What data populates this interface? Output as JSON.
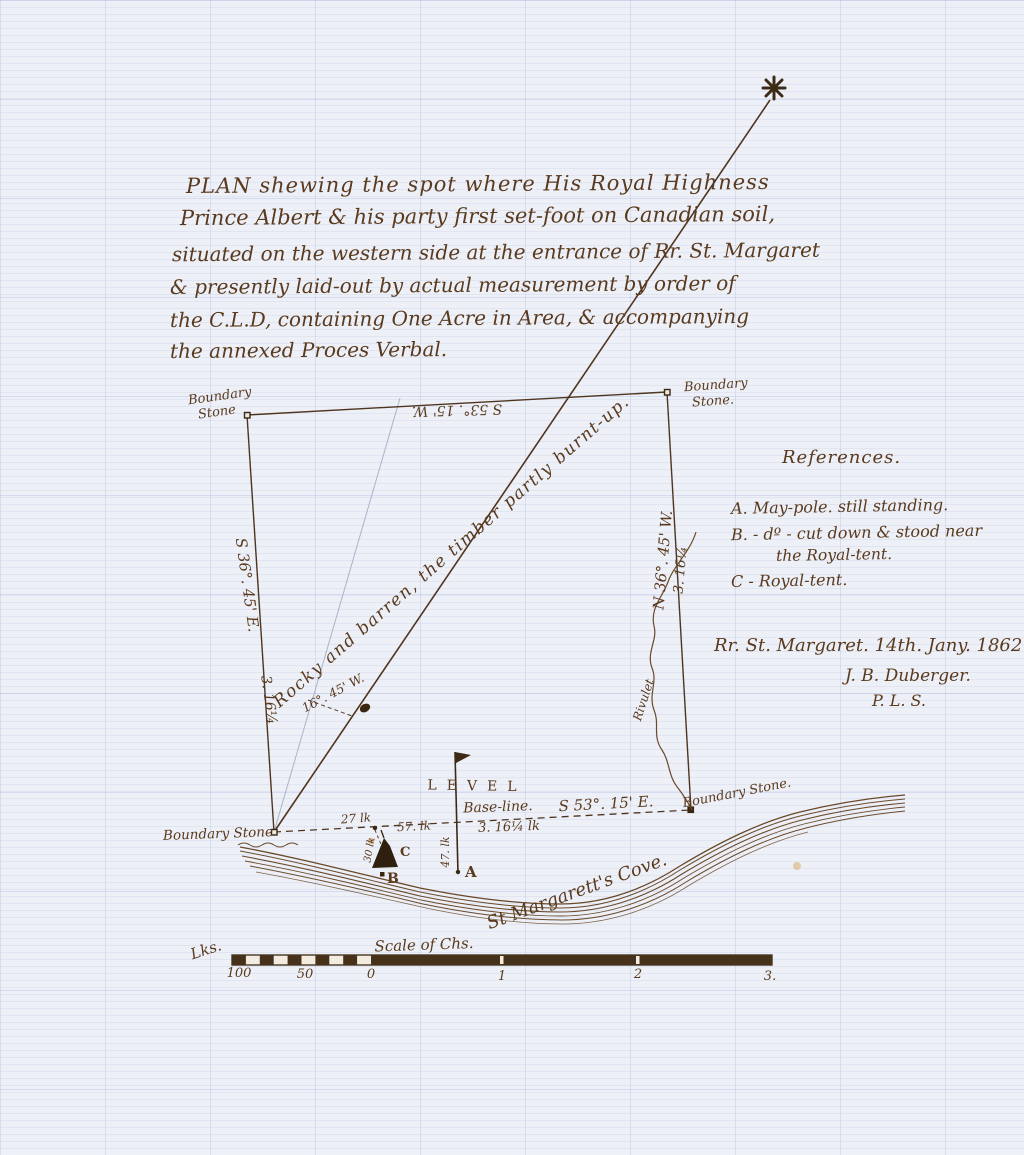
{
  "title_block": {
    "lines": [
      "PLAN shewing the spot where His Royal Highness",
      "Prince Albert & his party first set-foot on Canadian soil,",
      "situated on the western side at the entrance of Rr. St. Margaret",
      "& presently laid-out by actual measurement by order of",
      "the C.L.D, containing One Acre in Area, & accompanying",
      "the annexed Proces Verbal."
    ]
  },
  "plan": {
    "corners": {
      "top_left": {
        "line1": "Boundary",
        "line2": "Stone"
      },
      "top_right": {
        "line1": "Boundary",
        "line2": "Stone."
      },
      "bottom_left": {
        "label": "Boundary Stone"
      },
      "bottom_right": {
        "label": "Boundary Stone."
      }
    },
    "bearings": {
      "top": "S 53°. 15' W.",
      "left": "S 36°. 45' E.",
      "left_length": "3. 16¼",
      "right": "N 36°. 45' W.",
      "right_length": "3. 16¼",
      "base": "S 53°. 15' E."
    },
    "base_line": {
      "label": "Base-line.",
      "length": "3. 16¼ lk",
      "seg1": "27 lk",
      "seg2": "57. lk",
      "offset_a": "47. lk",
      "offset_b": "30 lk"
    },
    "variation": "16°. 45' W.",
    "terrain_note": "Rocky and barren, the timber partly burnt-up.",
    "level_station": "LEVEL",
    "points": {
      "a": "A",
      "b": "B",
      "c": "C"
    },
    "rivulet": "Rivulet",
    "cove": "St Margarett's Cove."
  },
  "references": {
    "heading": "References.",
    "item_a": "A.  May-pole. still standing.",
    "item_b1": "B.  - dº - cut down & stood near",
    "item_b2": "the Royal-tent.",
    "item_c": "C - Royal-tent."
  },
  "signature": {
    "place_date": "Rr. St. Margaret. 14th. Jany. 1862.",
    "name": "J. B. Duberger.",
    "credential": "P. L. S."
  },
  "scale_bar": {
    "title": "Scale of Chs.",
    "unit": "Lks.",
    "ticks": [
      "100",
      "50",
      "0",
      "1",
      "2",
      "3."
    ]
  },
  "colors": {
    "ink": "#5a3a1e",
    "paper": "#edf0f7",
    "grid": "#b9c7e4"
  }
}
